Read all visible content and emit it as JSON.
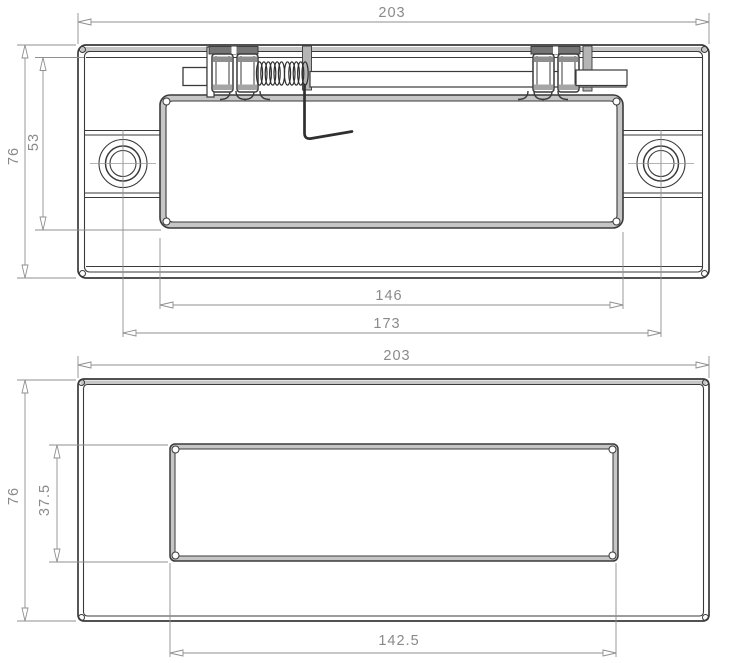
{
  "views": {
    "top": {
      "dimensions": {
        "overall_width": "203",
        "overall_height": "76",
        "inner_height": "53",
        "latch_plate_width": "146",
        "screw_hole_spacing": "173"
      }
    },
    "bottom": {
      "dimensions": {
        "overall_width": "203",
        "overall_height": "76",
        "cutout_height": "37.5",
        "cutout_width": "142.5"
      }
    }
  },
  "colors": {
    "part_line": "#3a3a3a",
    "dimension_line": "#8f8f8f",
    "dimension_text": "#8a8a8a",
    "background": "#ffffff",
    "edge_shading": "#c6c6c6"
  }
}
